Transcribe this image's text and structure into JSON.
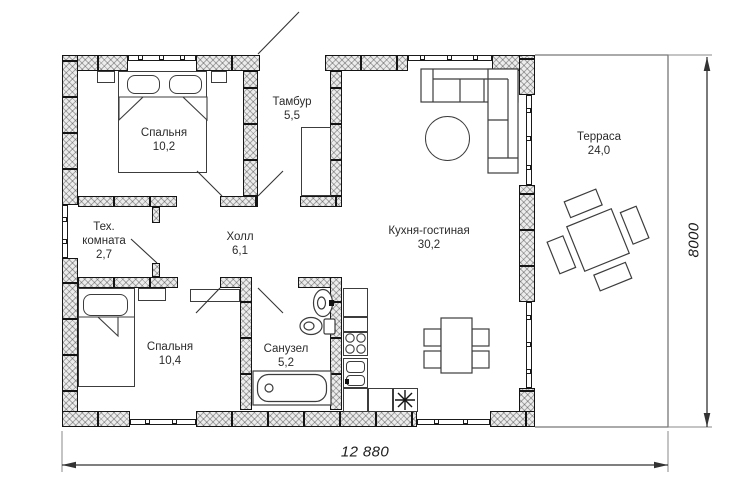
{
  "plan": {
    "rooms": {
      "bedroom1": {
        "name": "Спальня",
        "area": "10,2"
      },
      "tambour": {
        "name": "Тамбур",
        "area": "5,5"
      },
      "tech_room": {
        "name": "Тех. комната",
        "area": "2,7"
      },
      "hall": {
        "name": "Холл",
        "area": "6,1"
      },
      "bedroom2": {
        "name": "Спальня",
        "area": "10,4"
      },
      "bathroom": {
        "name": "Санузел",
        "area": "5,2"
      },
      "kitchen_living": {
        "name": "Кухня-гостиная",
        "area": "30,2"
      },
      "terrace": {
        "name": "Терраса",
        "area": "24,0"
      }
    },
    "dimensions": {
      "overall_width": "12 880",
      "overall_depth": "8000"
    },
    "colors": {
      "wall_line": "#141414",
      "wall_fill": "#ececec",
      "furniture_line": "#3c3c3c",
      "dimension_line": "#333333",
      "terrace_line": "#777777"
    }
  }
}
